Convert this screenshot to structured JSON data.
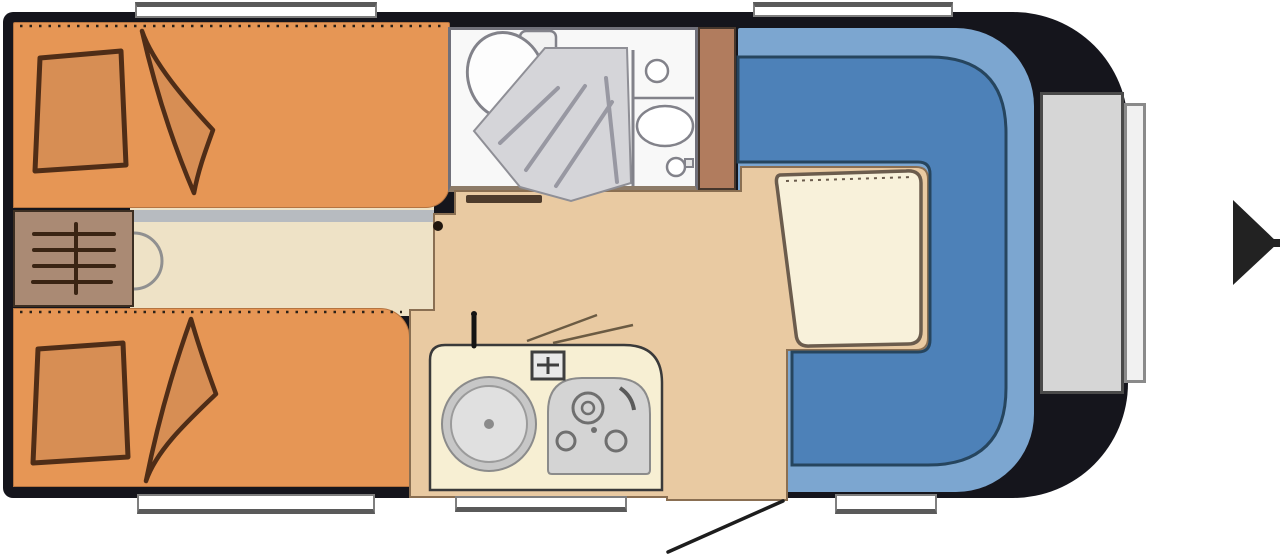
{
  "figure": {
    "kind": "caravan-floor-plan",
    "text_labels": []
  },
  "colors": {
    "canvasWhite": "#ffffff",
    "bodyShell": "#15151c",
    "bedOrange": "#e69655",
    "pillowFill": "#d78e54",
    "sketchBrown": "#4f2d17",
    "aisleCream": "#eee2c6",
    "aisleShadow": "#b7bbc0",
    "heaterBrown": "#aa8a74",
    "floorTan": "#e9caa2",
    "floorOutline": "#8a6f52",
    "bathroomWhite": "#f8f8f8",
    "fixtureStroke": "#82828a",
    "showerGray": "#d5d5d9",
    "showerStreak": "#9898a2",
    "wardrobeBrown": "#b17c5e",
    "loungeLight": "#7ca6d0",
    "benchBlue": "#4d81b8",
    "benchOutline": "#26455e",
    "tableCream": "#f8f1da",
    "tableStroke": "#6b5c4d",
    "counterCream": "#f7efd3",
    "counterStroke": "#3a3a3a",
    "applianceGray": "#d4d4d4",
    "applianceStroke": "#6f6f6f",
    "lockerGray": "#d6d6d6",
    "lockerStroke": "#4a4a4a",
    "windowWhite": "#ffffff",
    "windowFrame": "#7f7f7f",
    "windowBar": "#5a5a5a",
    "arrowBlack": "#222222",
    "lineDark": "#1d1d1d"
  }
}
